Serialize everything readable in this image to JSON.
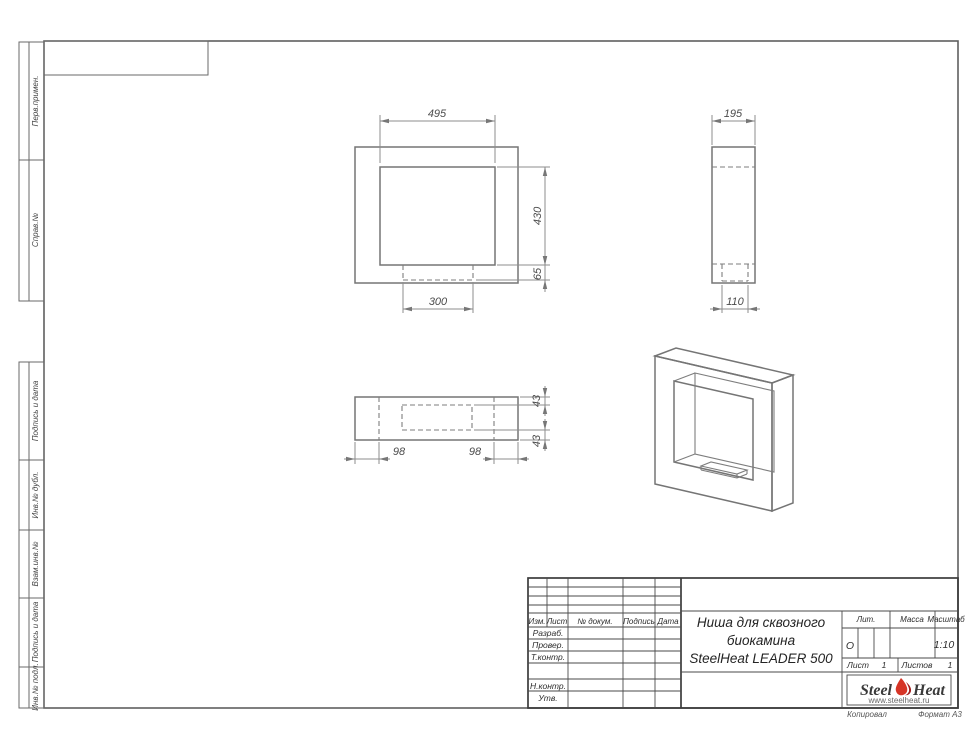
{
  "doc": {
    "title_line1": "Ниша для сквозного",
    "title_line2": "биокамина",
    "title_line3": "SteelHeat LEADER 500"
  },
  "stamps_left": [
    {
      "label": "Перв.примен."
    },
    {
      "label": "Справ.№"
    },
    {
      "label": "Подпись и дата"
    },
    {
      "label": "Инв.№ дубл."
    },
    {
      "label": "Взам.инв.№"
    },
    {
      "label": "Подпись и дата"
    },
    {
      "label": "Инв.№ подл."
    }
  ],
  "title_block": {
    "col_izm": "Изм.",
    "col_list": "Лист",
    "col_doc": "№ докум.",
    "col_sign": "Подпись",
    "col_date": "Дата",
    "row_razrab": "Разраб.",
    "row_prover": "Провер.",
    "row_tkontr": "Т.контр.",
    "row_nkontr": "Н.контр.",
    "row_utv": "Утв.",
    "lit_label": "Лит.",
    "lit_value": "О",
    "mass_label": "Масса",
    "scale_label": "Масштаб",
    "scale_value": "1:10",
    "sheet_label": "Лист",
    "sheet_value": "1",
    "sheets_label": "Листов",
    "sheets_value": "1"
  },
  "logo": {
    "part1": "Steel",
    "part2": "Heat",
    "site": "www.steelheat.ru",
    "flame_color": "#d63426",
    "flame_dark": "#a31f1f"
  },
  "footer": {
    "copied": "Копировал",
    "format": "Формат А3"
  },
  "views": {
    "front": {
      "dim_opening_width": "495",
      "dim_opening_height": "430",
      "dim_slot_height": "65",
      "dim_slot_width": "300"
    },
    "side": {
      "dim_depth": "195",
      "dim_slot_depth": "110"
    },
    "bottom": {
      "dim_border_left": "98",
      "dim_border_right": "98",
      "dim_gap_top": "43",
      "dim_gap_bottom": "43"
    }
  }
}
